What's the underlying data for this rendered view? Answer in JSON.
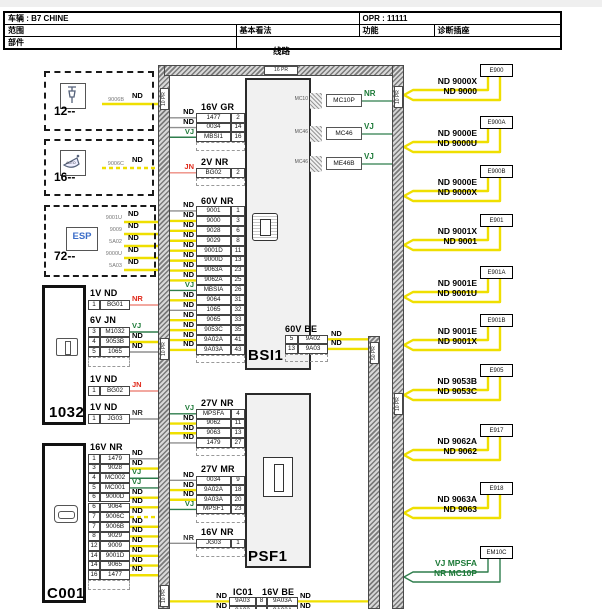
{
  "header": {
    "vehicle": "车辆 : B7 CHINE",
    "opr": "OPR : 11111",
    "scope": "范围",
    "basic_view": "基本看法",
    "function": "功能",
    "diag_socket": "诊断插座",
    "parts": "部件",
    "caption": "线路"
  },
  "colors": {
    "nd_wire": "#efdf00",
    "vj_wire": "#2e7d4c",
    "red_wire": "#ee8b80",
    "gray_wire": "#8f8f8f",
    "green_text": "#1d7a38",
    "red_text": "#e0291a",
    "esp_blue": "#3a6cc8"
  },
  "harnesses": {
    "top": {
      "label": "16 PR"
    },
    "left": {
      "labels": [
        "10 PR",
        "10 PR",
        "10 PR"
      ]
    },
    "right": {
      "labels": [
        "10 PR",
        "10 PR"
      ]
    },
    "inner": {
      "label": "50 PR"
    }
  },
  "components": [
    {
      "id": "comp-12",
      "label": "12--",
      "icon": "plug-icon",
      "wires": [
        {
          "code": "9006B",
          "color_label": "ND",
          "color": "nd",
          "dashed": false
        }
      ]
    },
    {
      "id": "comp-16",
      "label": "16--",
      "icon": "mirror-icon",
      "wires": [
        {
          "code": "9006C",
          "color_label": "ND",
          "color": "nd",
          "dashed": true
        }
      ]
    },
    {
      "id": "comp-esp",
      "label": "72--",
      "icon": "esp-icon",
      "icon_text": "ESP",
      "wires": [
        {
          "code": "9001U",
          "color_label": "ND",
          "color": "nd"
        },
        {
          "code": "9009",
          "color_label": "ND",
          "color": "nd"
        },
        {
          "code": "5A02",
          "color_label": "ND",
          "color": "nd"
        },
        {
          "code": "9000U",
          "color_label": "ND",
          "color": "nd"
        },
        {
          "code": "5A03",
          "color_label": "ND",
          "color": "nd"
        }
      ]
    }
  ],
  "connector_1032": {
    "label": "1032",
    "groups": [
      {
        "header": "1V ND",
        "dashed_row": false,
        "rows": [
          {
            "pin": "1",
            "name": "BG01",
            "color_label": "NR",
            "color": "red"
          }
        ]
      },
      {
        "header": "6V JN",
        "dashed_row": true,
        "rows": [
          {
            "pin": "3",
            "name": "M1032",
            "color_label": "VJ",
            "color": "vj"
          },
          {
            "pin": "4",
            "name": "9053B",
            "color_label": "ND",
            "color": "nd"
          },
          {
            "pin": "5",
            "name": "1065",
            "color_label": "ND",
            "color": "gray"
          }
        ]
      },
      {
        "header": "1V ND",
        "dashed_row": false,
        "rows": [
          {
            "pin": "1",
            "name": "BG02",
            "color_label": "JN",
            "color": "red"
          }
        ]
      },
      {
        "header": "1V ND",
        "dashed_row": false,
        "rows": [
          {
            "pin": "1",
            "name": "JG03",
            "color_label": "NR",
            "color": "gray"
          }
        ]
      }
    ]
  },
  "connector_c001": {
    "label": "C001",
    "header": "16V NR",
    "dashed_row": true,
    "rows": [
      {
        "pin": "1",
        "name": "1479",
        "color_label": "ND",
        "color": "gray"
      },
      {
        "pin": "3",
        "name": "9028",
        "color_label": "ND",
        "color": "nd"
      },
      {
        "pin": "4",
        "name": "MC002",
        "color_label": "VJ",
        "color": "vj"
      },
      {
        "pin": "5",
        "name": "MC001",
        "color_label": "VJ",
        "color": "vj"
      },
      {
        "pin": "6",
        "name": "9000D",
        "color_label": "ND",
        "color": "nd"
      },
      {
        "pin": "6",
        "name": "9064",
        "color_label": "ND",
        "color": "nd"
      },
      {
        "pin": "7",
        "name": "9006C",
        "color_label": "ND",
        "color": "nd",
        "dashed": true
      },
      {
        "pin": "7",
        "name": "9006B",
        "color_label": "ND",
        "color": "nd"
      },
      {
        "pin": "8",
        "name": "9029",
        "color_label": "ND",
        "color": "nd"
      },
      {
        "pin": "12",
        "name": "9009",
        "color_label": "ND",
        "color": "nd"
      },
      {
        "pin": "14",
        "name": "9001D",
        "color_label": "ND",
        "color": "nd"
      },
      {
        "pin": "14",
        "name": "9065",
        "color_label": "ND",
        "color": "nd"
      },
      {
        "pin": "16",
        "name": "1477",
        "color_label": "ND",
        "color": "nd"
      }
    ]
  },
  "bsi1": {
    "label": "BSI1",
    "left_tables": [
      {
        "header": "16V GR",
        "dashed_row": true,
        "rows": [
          {
            "name": "1477",
            "pin": "2",
            "color_label": "ND",
            "color": "gray"
          },
          {
            "name": "0034",
            "pin": "14",
            "color_label": "ND",
            "color": "gray"
          },
          {
            "name": "MBSI1",
            "pin": "16",
            "color_label": "VJ",
            "color": "vj"
          }
        ]
      },
      {
        "header": "2V NR",
        "dashed_row": true,
        "rows": [
          {
            "name": "BG02",
            "pin": "2",
            "color_label": "JN",
            "color": "red"
          }
        ]
      },
      {
        "header": "60V NR",
        "dashed_row": true,
        "rows": [
          {
            "name": "9001",
            "pin": "1",
            "color_label": "ND",
            "color": "gray"
          },
          {
            "name": "9000",
            "pin": "3",
            "color_label": "ND",
            "color": "nd"
          },
          {
            "name": "9028",
            "pin": "6",
            "color_label": "ND",
            "color": "nd"
          },
          {
            "name": "9029",
            "pin": "8",
            "color_label": "ND",
            "color": "nd"
          },
          {
            "name": "9001D",
            "pin": "11",
            "color_label": "ND",
            "color": "nd"
          },
          {
            "name": "9000D",
            "pin": "13",
            "color_label": "ND",
            "color": "nd"
          },
          {
            "name": "9063A",
            "pin": "23",
            "color_label": "ND",
            "color": "nd"
          },
          {
            "name": "9062A",
            "pin": "25",
            "color_label": "ND",
            "color": "nd"
          },
          {
            "name": "MBSIA",
            "pin": "26",
            "color_label": "VJ",
            "color": "vj"
          },
          {
            "name": "9064",
            "pin": "31",
            "color_label": "ND",
            "color": "nd"
          },
          {
            "name": "1065",
            "pin": "32",
            "color_label": "ND",
            "color": "gray"
          },
          {
            "name": "9065",
            "pin": "33",
            "color_label": "ND",
            "color": "nd"
          },
          {
            "name": "9053C",
            "pin": "35",
            "color_label": "ND",
            "color": "nd"
          },
          {
            "name": "9A02A",
            "pin": "41",
            "color_label": "ND",
            "color": "nd"
          },
          {
            "name": "9A03A",
            "pin": "43",
            "color_label": "ND",
            "color": "nd"
          }
        ]
      }
    ],
    "right_table": {
      "header": "60V BE",
      "dashed_row": true,
      "rows": [
        {
          "pin": "5",
          "name": "9A02",
          "color_label": "ND",
          "color": "nd"
        },
        {
          "pin": "13",
          "name": "9A03",
          "color_label": "ND",
          "color": "nd"
        }
      ]
    }
  },
  "psf1": {
    "label": "PSF1",
    "left_tables": [
      {
        "header": "27V NR",
        "dashed_row": true,
        "rows": [
          {
            "name": "MPSFA",
            "pin": "4",
            "color_label": "VJ",
            "color": "vj"
          },
          {
            "name": "9062",
            "pin": "11",
            "color_label": "ND",
            "color": "nd"
          },
          {
            "name": "9063",
            "pin": "13",
            "color_label": "ND",
            "color": "nd"
          },
          {
            "name": "1479",
            "pin": "27",
            "color_label": "ND",
            "color": "gray"
          }
        ]
      },
      {
        "header": "27V MR",
        "dashed_row": true,
        "rows": [
          {
            "name": "0034",
            "pin": "9",
            "color_label": "ND",
            "color": "gray"
          },
          {
            "name": "9A02A",
            "pin": "18",
            "color_label": "ND",
            "color": "nd"
          },
          {
            "name": "9A03A",
            "pin": "20",
            "color_label": "ND",
            "color": "nd"
          },
          {
            "name": "MPSF1",
            "pin": "23",
            "color_label": "VJ",
            "color": "vj"
          }
        ]
      },
      {
        "header": "16V NR",
        "dashed_row": true,
        "rows": [
          {
            "name": "JG03",
            "pin": "1",
            "color_label": "NR",
            "color": "gray"
          }
        ]
      }
    ]
  },
  "ic01": {
    "label": "IC01",
    "header": "16V BE",
    "rows": [
      {
        "left_label": "ND",
        "name_left": "9A03",
        "pin": "8",
        "name_right": "9A03A",
        "right_label": "ND",
        "color": "nd"
      },
      {
        "left_label": "ND",
        "name_left": "9A02",
        "pin": "",
        "name_right": "9A02A",
        "right_label": "ND",
        "color": "nd"
      }
    ]
  },
  "splices": [
    {
      "tag": "MC10",
      "box": "MC10P",
      "wire_label": "NR",
      "color": "vj"
    },
    {
      "tag": "MC46",
      "box": "MC46",
      "wire_label": "VJ",
      "color": "vj"
    },
    {
      "tag": "MC46",
      "box": "ME46B",
      "wire_label": "VJ",
      "color": "vj"
    }
  ],
  "grounds": [
    {
      "id": "E900",
      "wires": [
        {
          "label": "ND 9000X",
          "color": "nd"
        },
        {
          "label": "ND 9000",
          "color": "nd"
        }
      ]
    },
    {
      "id": "E900A",
      "wires": [
        {
          "label": "ND 9000E",
          "color": "nd"
        },
        {
          "label": "ND 9000U",
          "color": "nd"
        }
      ]
    },
    {
      "id": "E900B",
      "wires": [
        {
          "label": "ND 9000E",
          "color": "nd"
        },
        {
          "label": "ND 9000X",
          "color": "nd"
        }
      ]
    },
    {
      "id": "E901",
      "wires": [
        {
          "label": "ND 9001X",
          "color": "nd"
        },
        {
          "label": "ND 9001",
          "color": "nd"
        }
      ]
    },
    {
      "id": "E901A",
      "wires": [
        {
          "label": "ND 9001E",
          "color": "nd"
        },
        {
          "label": "ND 9001U",
          "color": "nd"
        }
      ]
    },
    {
      "id": "E901B",
      "wires": [
        {
          "label": "ND 9001E",
          "color": "nd"
        },
        {
          "label": "ND 9001X",
          "color": "nd"
        }
      ]
    },
    {
      "id": "E905",
      "wires": [
        {
          "label": "ND 9053B",
          "color": "nd"
        },
        {
          "label": "ND 9053C",
          "color": "nd"
        }
      ]
    },
    {
      "id": "E917",
      "wires": [
        {
          "label": "ND 9062A",
          "color": "nd"
        },
        {
          "label": "ND 9062",
          "color": "nd"
        }
      ]
    },
    {
      "id": "E918",
      "wires": [
        {
          "label": "ND 9063A",
          "color": "nd"
        },
        {
          "label": "ND 9063",
          "color": "nd"
        }
      ]
    },
    {
      "id": "EM10C",
      "wires": [
        {
          "label": "VJ MPSFA",
          "color": "vj",
          "text_color": "green"
        },
        {
          "label": "NR MC10P",
          "color": "vj",
          "text_color": "green"
        }
      ]
    }
  ]
}
